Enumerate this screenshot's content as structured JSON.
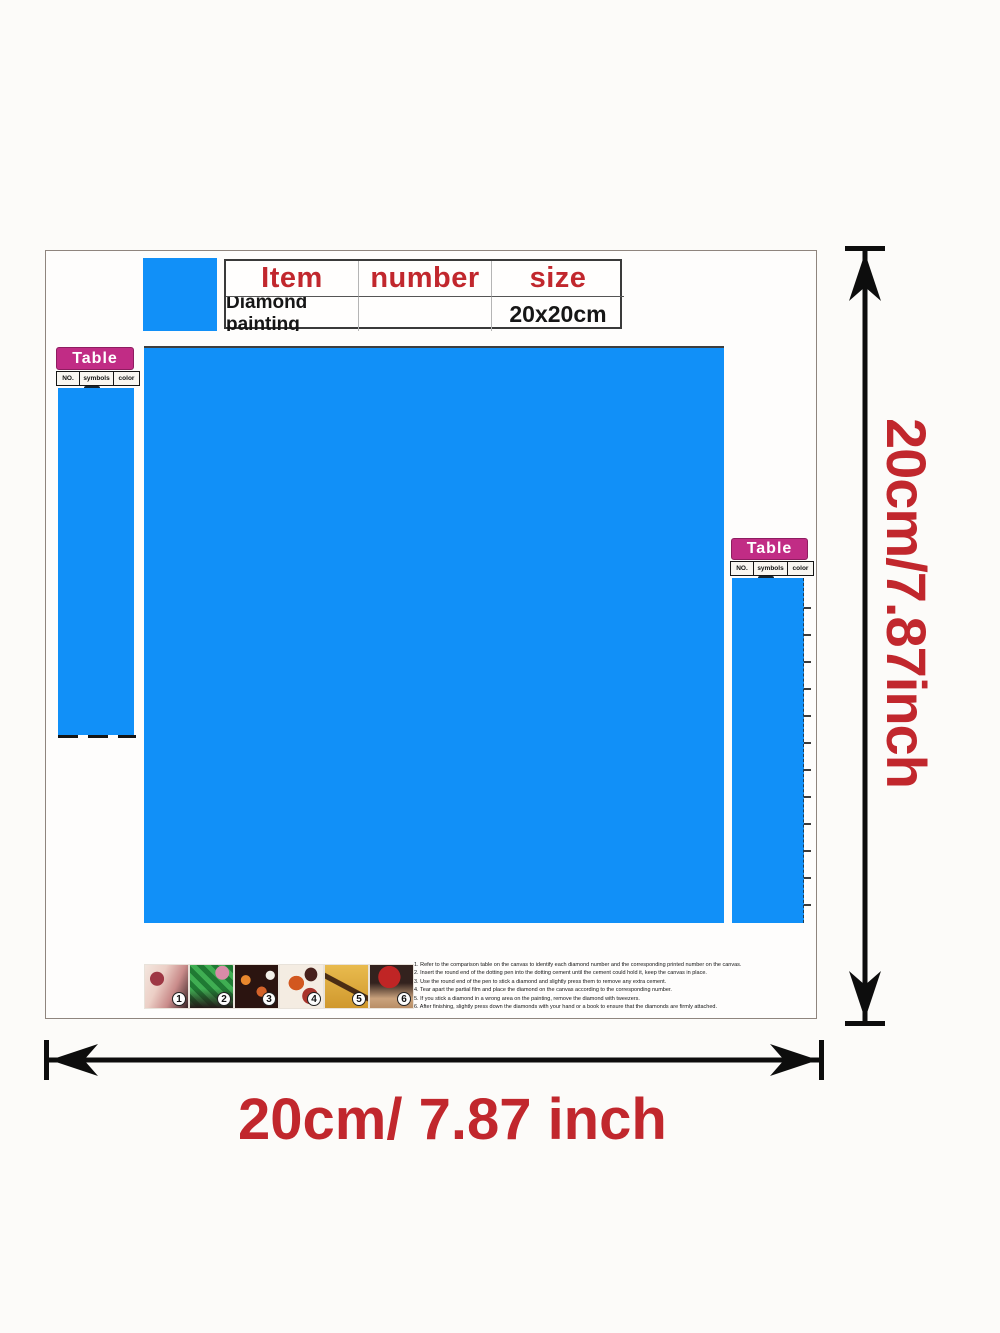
{
  "colors": {
    "canvas_blue": "#1190f8",
    "table_magenta": "#c12c85",
    "accent_red": "#c1272d"
  },
  "spec_table": {
    "headers": [
      "Item",
      "number",
      "size"
    ],
    "row": [
      "Diamond painting",
      "",
      "20x20cm"
    ]
  },
  "color_table_left": {
    "title": "Table",
    "columns": [
      "NO.",
      "symbols",
      "color"
    ]
  },
  "color_table_right": {
    "title": "Table",
    "columns": [
      "NO.",
      "symbols",
      "color"
    ]
  },
  "dimension_labels": {
    "vertical": "20cm/7.87inch",
    "horizontal": "20cm/ 7.87 inch"
  },
  "steps": {
    "numbers": [
      "1",
      "2",
      "3",
      "4",
      "5",
      "6"
    ],
    "instructions": [
      "1. Refer to the comparison table on the canvas to identify each diamond number and the corresponding printed number on the canvas.",
      "2. Insert the round end of the dotting pen into the dotting cement until the cement could hold it, keep the canvas in place.",
      "3. Use the round end of the pen to stick a diamond and slightly press them to remove any extra cement.",
      "4. Tear apart the partial film and place the diamond on the canvas according to the corresponding number.",
      "5. If you stick a diamond in a wrong area on the painting, remove the diamond with tweezers.",
      "6. After finishing, slightly press down the diamonds with your hand or a book to ensure that the diamonds are firmly attached."
    ]
  }
}
